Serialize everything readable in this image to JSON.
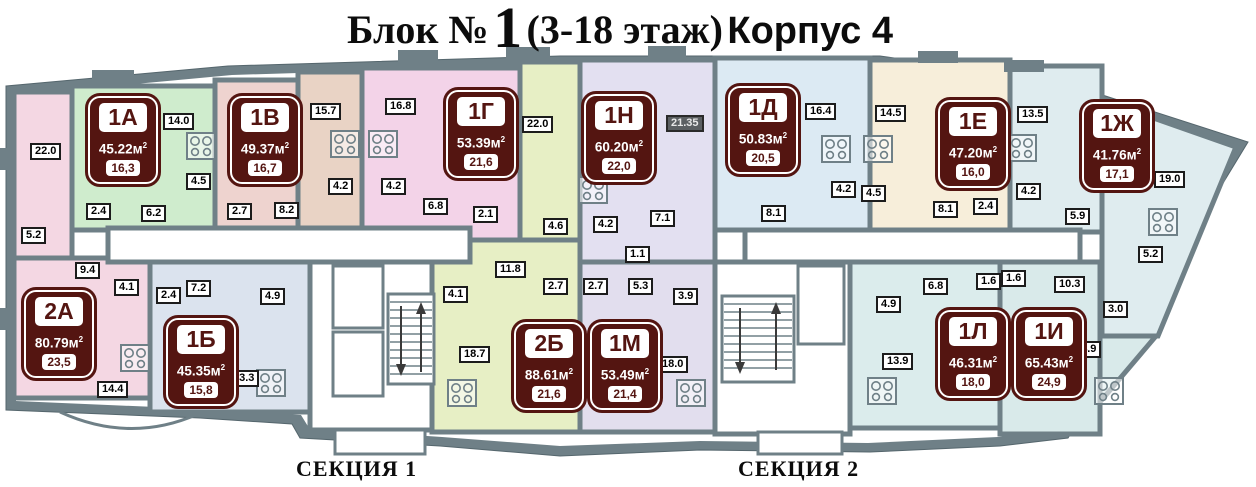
{
  "title": {
    "part1": "Блок №",
    "number": "1",
    "part2": "(3-18 этаж)",
    "part3": "Корпус 4"
  },
  "sections": {
    "s1": "СЕКЦИЯ 1",
    "s2": "СЕКЦИЯ 2"
  },
  "colors": {
    "wall": "#6f8087",
    "paper": "#ffffff",
    "apt_2a": "#f4d7e3",
    "apt_1a": "#cfeccd",
    "apt_1v": "#eed3cf",
    "room_157": "#e9d3c5",
    "apt_1g": "#f3d3e8",
    "apt_2b": "#e7efc5",
    "apt_1n": "#e3e0f1",
    "apt_1m": "#e2deee",
    "apt_1b": "#dbe3ee",
    "apt_1d": "#dceaf3",
    "apt_1e": "#f7eeda",
    "apt_1zh": "#dfecef",
    "apt_1l": "#dbecec",
    "apt_1i": "#d9eaea",
    "badge": "#541511"
  },
  "apartments": [
    {
      "id": "1А",
      "total": "45.22м",
      "sup": "2",
      "living": "16,3",
      "x": 88,
      "y": 96
    },
    {
      "id": "1В",
      "total": "49.37м",
      "sup": "2",
      "living": "16,7",
      "x": 230,
      "y": 96
    },
    {
      "id": "1Г",
      "total": "53.39м",
      "sup": "2",
      "living": "21,6",
      "x": 446,
      "y": 90
    },
    {
      "id": "1Н",
      "total": "60.20м",
      "sup": "2",
      "living": "22,0",
      "x": 584,
      "y": 94
    },
    {
      "id": "1Д",
      "total": "50.83м",
      "sup": "2",
      "living": "20,5",
      "x": 728,
      "y": 86
    },
    {
      "id": "1Е",
      "total": "47.20м",
      "sup": "2",
      "living": "16,0",
      "x": 938,
      "y": 100
    },
    {
      "id": "1Ж",
      "total": "41.76м",
      "sup": "2",
      "living": "17,1",
      "x": 1082,
      "y": 102
    },
    {
      "id": "2А",
      "total": "80.79м",
      "sup": "2",
      "living": "23,5",
      "x": 24,
      "y": 290
    },
    {
      "id": "1Б",
      "total": "45.35м",
      "sup": "2",
      "living": "15,8",
      "x": 166,
      "y": 318
    },
    {
      "id": "2Б",
      "total": "88.61м",
      "sup": "2",
      "living": "21,6",
      "x": 514,
      "y": 322
    },
    {
      "id": "1М",
      "total": "53.49м",
      "sup": "2",
      "living": "21,4",
      "x": 590,
      "y": 322
    },
    {
      "id": "1Л",
      "total": "46.31м",
      "sup": "2",
      "living": "18,0",
      "x": 938,
      "y": 310
    },
    {
      "id": "1И",
      "total": "65.43м",
      "sup": "2",
      "living": "24,9",
      "x": 1014,
      "y": 310
    }
  ],
  "room_labels": [
    {
      "text": "22.0",
      "x": 30,
      "y": 143
    },
    {
      "text": "14.0",
      "x": 163,
      "y": 113
    },
    {
      "text": "4.5",
      "x": 186,
      "y": 173
    },
    {
      "text": "2.4",
      "x": 86,
      "y": 203
    },
    {
      "text": "6.2",
      "x": 141,
      "y": 205
    },
    {
      "text": "5.2",
      "x": 21,
      "y": 227
    },
    {
      "text": "9.4",
      "x": 75,
      "y": 262
    },
    {
      "text": "4.1",
      "x": 114,
      "y": 279
    },
    {
      "text": "2.4",
      "x": 156,
      "y": 287
    },
    {
      "text": "7.2",
      "x": 186,
      "y": 280
    },
    {
      "text": "4.9",
      "x": 260,
      "y": 288
    },
    {
      "text": "14.4",
      "x": 97,
      "y": 381
    },
    {
      "text": "13.3",
      "x": 228,
      "y": 370
    },
    {
      "text": "2.7",
      "x": 227,
      "y": 203
    },
    {
      "text": "8.2",
      "x": 274,
      "y": 202
    },
    {
      "text": "15.7",
      "x": 310,
      "y": 103
    },
    {
      "text": "16.8",
      "x": 385,
      "y": 98
    },
    {
      "text": "4.2",
      "x": 328,
      "y": 178
    },
    {
      "text": "4.2",
      "x": 381,
      "y": 178
    },
    {
      "text": "6.8",
      "x": 423,
      "y": 198
    },
    {
      "text": "2.1",
      "x": 473,
      "y": 206
    },
    {
      "text": "22.0",
      "x": 522,
      "y": 116
    },
    {
      "text": "4.6",
      "x": 543,
      "y": 218
    },
    {
      "text": "11.8",
      "x": 495,
      "y": 261
    },
    {
      "text": "2.7",
      "x": 543,
      "y": 278
    },
    {
      "text": "4.1",
      "x": 443,
      "y": 286
    },
    {
      "text": "18.7",
      "x": 459,
      "y": 346
    },
    {
      "text": "21.35",
      "x": 666,
      "y": 115,
      "dark": true
    },
    {
      "text": "4.2",
      "x": 593,
      "y": 216
    },
    {
      "text": "7.1",
      "x": 650,
      "y": 210
    },
    {
      "text": "1.1",
      "x": 625,
      "y": 246
    },
    {
      "text": "2.7",
      "x": 583,
      "y": 278
    },
    {
      "text": "5.3",
      "x": 628,
      "y": 278
    },
    {
      "text": "3.9",
      "x": 673,
      "y": 288
    },
    {
      "text": "18.0",
      "x": 657,
      "y": 356
    },
    {
      "text": "16.4",
      "x": 805,
      "y": 103
    },
    {
      "text": "8.1",
      "x": 761,
      "y": 205
    },
    {
      "text": "4.2",
      "x": 831,
      "y": 181
    },
    {
      "text": "14.5",
      "x": 875,
      "y": 105
    },
    {
      "text": "4.5",
      "x": 861,
      "y": 185
    },
    {
      "text": "8.1",
      "x": 933,
      "y": 201
    },
    {
      "text": "2.4",
      "x": 973,
      "y": 198
    },
    {
      "text": "13.5",
      "x": 1017,
      "y": 106
    },
    {
      "text": "4.2",
      "x": 1016,
      "y": 183
    },
    {
      "text": "5.9",
      "x": 1065,
      "y": 208
    },
    {
      "text": "19.0",
      "x": 1154,
      "y": 171
    },
    {
      "text": "5.2",
      "x": 1138,
      "y": 246
    },
    {
      "text": "6.8",
      "x": 923,
      "y": 278
    },
    {
      "text": "4.9",
      "x": 876,
      "y": 296
    },
    {
      "text": "1.6",
      "x": 976,
      "y": 273
    },
    {
      "text": "1.6",
      "x": 1001,
      "y": 270
    },
    {
      "text": "10.3",
      "x": 1054,
      "y": 276
    },
    {
      "text": "3.0",
      "x": 1103,
      "y": 301
    },
    {
      "text": "13.9",
      "x": 882,
      "y": 353
    },
    {
      "text": "24.9",
      "x": 1070,
      "y": 341
    }
  ],
  "stoves": [
    {
      "x": 186,
      "y": 132
    },
    {
      "x": 330,
      "y": 130
    },
    {
      "x": 368,
      "y": 130
    },
    {
      "x": 578,
      "y": 176
    },
    {
      "x": 821,
      "y": 135
    },
    {
      "x": 863,
      "y": 135
    },
    {
      "x": 1007,
      "y": 134
    },
    {
      "x": 1148,
      "y": 208
    },
    {
      "x": 120,
      "y": 344
    },
    {
      "x": 256,
      "y": 369
    },
    {
      "x": 447,
      "y": 379
    },
    {
      "x": 676,
      "y": 379
    },
    {
      "x": 867,
      "y": 377
    },
    {
      "x": 1094,
      "y": 377
    }
  ]
}
